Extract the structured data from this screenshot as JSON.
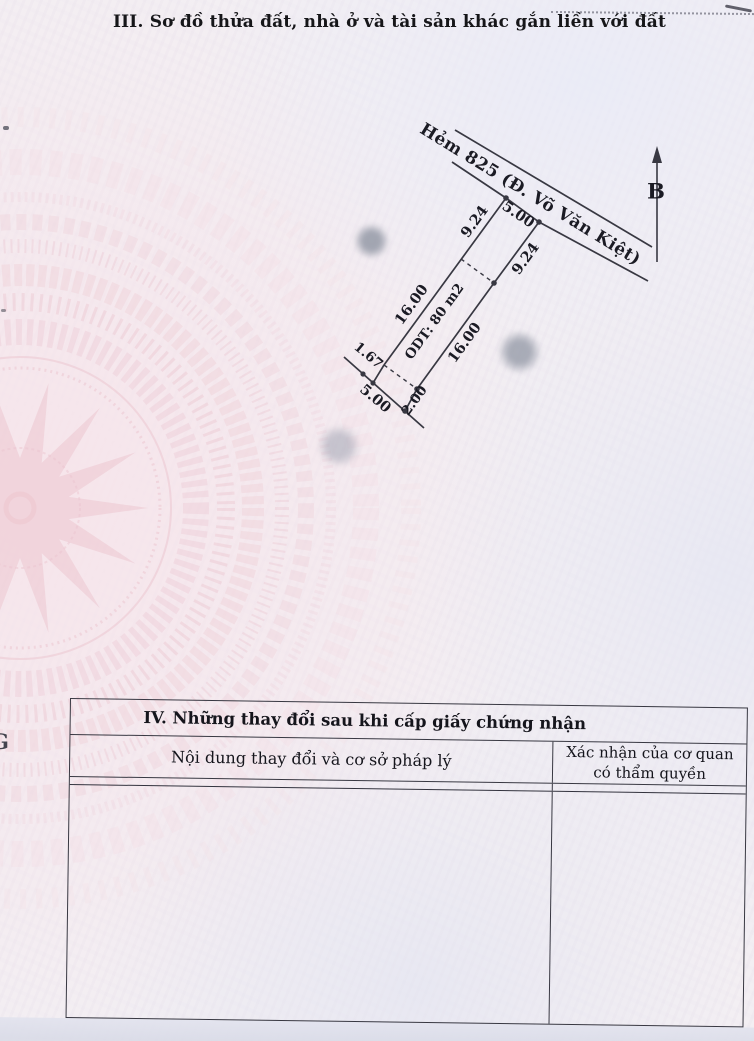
{
  "page": {
    "section3_title": "III. Sơ đồ thửa đất, nhà ở và tài sản khác gắn liền với đất",
    "left_edge_fragment": "G"
  },
  "diagram": {
    "road_label": "Hẻm 825 (Đ. Võ Văn Kiệt)",
    "north_label": "B",
    "plot_area_label": "ODT: 80 m2",
    "dims": {
      "left_depth_front": "9.24",
      "front_width": "5.00",
      "right_depth_front": "9.24",
      "left_depth_main": "16.00",
      "right_depth_main": "16.00",
      "rear_offset_left": "1.67",
      "rear_width": "5.00",
      "rear_offset_right": "2.00"
    }
  },
  "table": {
    "section4_title": "IV. Những thay đổi sau khi cấp giấy chứng nhận",
    "col1_header": "Nội dung thay đổi và cơ sở pháp lý",
    "col2_header_line1": "Xác nhận của cơ quan",
    "col2_header_line2": "có thẩm quyền"
  },
  "colors": {
    "line": "#383842",
    "watermark_pink": "#ecc4ce",
    "paper": "#f3eff3",
    "bottom_band": "#dcdee9"
  }
}
